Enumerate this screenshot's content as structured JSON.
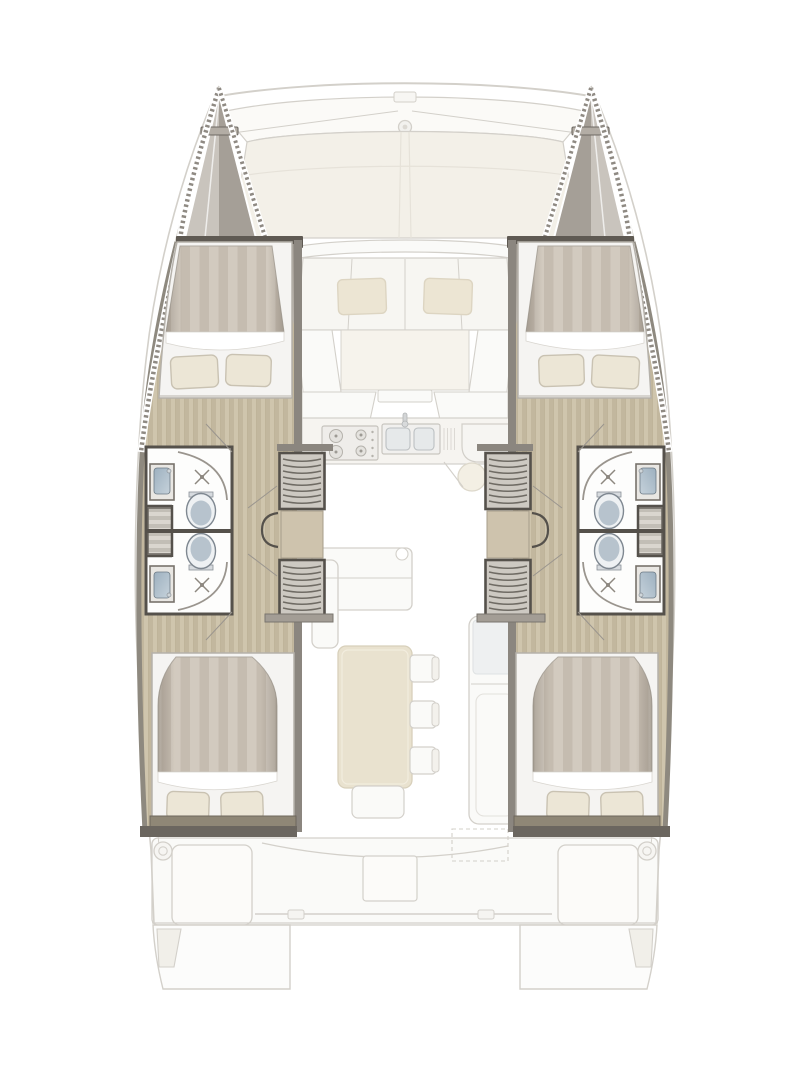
{
  "plan": {
    "vessel_type": "catamaran",
    "view": "Overhead interior deck plan of a sailing catamaran",
    "symmetry": "port and starboard hulls mirrored",
    "hulls": [
      {
        "side": "port",
        "sections": [
          {
            "name": "bow peak",
            "features": [
              "rope-edged bow",
              "anchor crossbar"
            ]
          },
          {
            "name": "forward cabin",
            "features": [
              "double berth with striped duvet",
              "two pillows",
              "white berth frame"
            ]
          },
          {
            "name": "forward bathroom",
            "features": [
              "shower with drain",
              "washbasin",
              "marine toilet"
            ]
          },
          {
            "name": "companionway",
            "features": [
              "forward steps",
              "landing with cabin doors",
              "aft steps"
            ]
          },
          {
            "name": "aft bathroom",
            "features": [
              "washbasin",
              "marine toilet",
              "shower with drain"
            ]
          },
          {
            "name": "aft cabin",
            "features": [
              "double berth with striped duvet",
              "two pillows",
              "foot platform"
            ]
          }
        ]
      },
      {
        "side": "starboard",
        "sections": [
          {
            "name": "bow peak"
          },
          {
            "name": "forward cabin"
          },
          {
            "name": "forward bathroom"
          },
          {
            "name": "companionway"
          },
          {
            "name": "aft bathroom"
          },
          {
            "name": "aft cabin"
          }
        ]
      }
    ],
    "center_sections": [
      {
        "name": "foredeck",
        "features": [
          "crossbeam",
          "bowsprit ring fitting",
          "deck panels"
        ]
      },
      {
        "name": "forward cockpit",
        "features": [
          "bench seat",
          "two cushions"
        ]
      },
      {
        "name": "galley",
        "features": [
          "stove with four burners",
          "double sink with faucet",
          "drainboard",
          "counter",
          "round stool"
        ]
      },
      {
        "name": "saloon",
        "features": [
          "L-shaped sofa",
          "rectangular table",
          "three chairs",
          "bench",
          "fridge / chart-seat module"
        ]
      },
      {
        "name": "aft cockpit",
        "features": [
          "two side benches",
          "center table",
          "stern rail",
          "two winches",
          "sliding door curve"
        ]
      },
      {
        "name": "transom",
        "features": [
          "port swim platform",
          "starboard swim platform"
        ]
      }
    ]
  },
  "legend": {
    "port_hull": "Port hull",
    "starboard_hull": "Starboard hull",
    "forward_cabin": "Forward double cabin",
    "aft_cabin": "Aft double cabin",
    "forward_head": "Forward bathroom",
    "aft_head": "Aft bathroom",
    "shower": "Shower",
    "toilet": "Marine toilet",
    "washbasin": "Washbasin",
    "stairs": "Companionway steps",
    "landing": "Companionway landing",
    "bow_peak": "Bow peak locker",
    "berth": "Double berth",
    "foredeck": "Foredeck",
    "forward_cockpit": "Forward cockpit",
    "galley": "Galley",
    "stove": "Stove",
    "galley_sink": "Galley double sink",
    "saloon": "Saloon",
    "saloon_table": "Saloon table",
    "sofa": "Saloon sofa",
    "chairs": "Dining chairs",
    "aft_cockpit": "Aft cockpit",
    "swim_platform": "Swim platform",
    "winch": "Winch"
  },
  "colors": {
    "background": "#ffffff",
    "wall": "#55514b",
    "wall_light": "#8b867f",
    "wood_a": "#cfc5ad",
    "wood_b": "#c2b79e",
    "wood_line": "#b0a488",
    "duvet_a": "#d2cabf",
    "duvet_b": "#c5bcb0",
    "tread_a": "#dad6cf",
    "tread_b": "#c2beb6",
    "pillow": "#ece6d6",
    "pillow_edge": "#c9c2b2",
    "bed_frame": "#f5f4f2",
    "basin": "#9db0bf",
    "basin_light": "#c6d2db",
    "toilet": "#b7c3cd",
    "glass": "#eef0f1",
    "tri_light": "#c9c4bd",
    "tri_dark": "#a59f97",
    "rope": "#8f8a83",
    "cream": "#f3f0e8",
    "faded_stroke": "#d3d0ca",
    "faded_fill": "#fafaf8",
    "cushion": "#ece5d3",
    "table": "#e9e2cf",
    "platform": "#8f8776"
  }
}
